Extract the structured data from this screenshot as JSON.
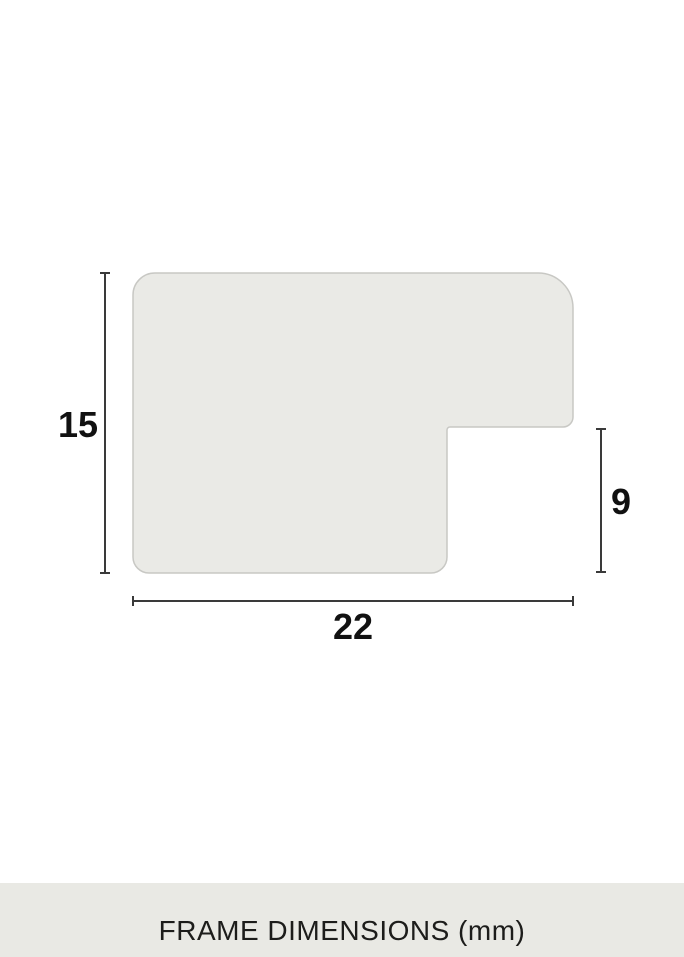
{
  "diagram": {
    "type": "frame-profile-cross-section",
    "dimensions": [
      {
        "name": "profile-height",
        "label": "15",
        "value": 15,
        "unit": "mm"
      },
      {
        "name": "rebate-depth",
        "label": "9",
        "value": 9,
        "unit": "mm"
      },
      {
        "name": "profile-width",
        "label": "22",
        "value": 22,
        "unit": "mm"
      }
    ],
    "colors": {
      "shape_fill": "#eaeae6",
      "shape_border": "#c8c8c4",
      "dimension_line": "#3a3a3a",
      "label_text": "#111111"
    }
  },
  "footer": {
    "title": "FRAME DIMENSIONS (mm)",
    "background": "#e9e9e4",
    "text_color": "#1d1d1b"
  }
}
